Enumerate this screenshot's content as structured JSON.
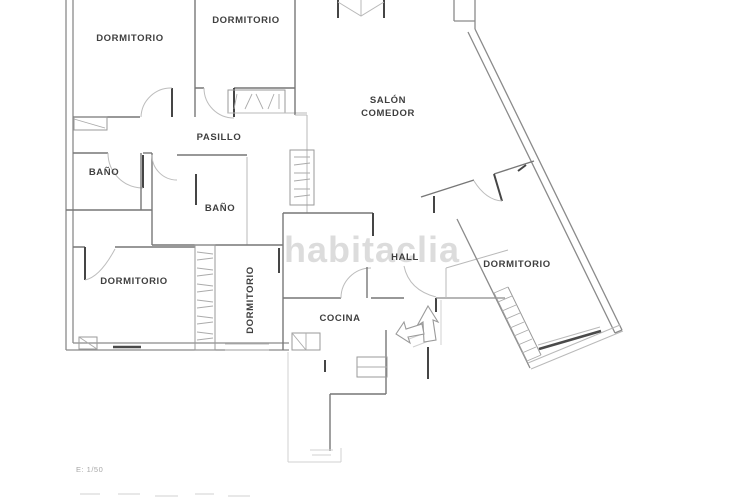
{
  "watermark": {
    "text": "habitaclia",
    "color": "#dcdcdc"
  },
  "scale_note": {
    "text": "E: 1/50"
  },
  "labels": {
    "dormitorio_top_left": "DORMITORIO",
    "dormitorio_top_mid": "DORMITORIO",
    "salon_line1": "SALÓN",
    "salon_line2": "COMEDOR",
    "pasillo": "PASILLO",
    "bano_left": "BAÑO",
    "bano_mid": "BAÑO",
    "dormitorio_bottom_left": "DORMITORIO",
    "dormitorio_bottom_mid": "DORMITORIO",
    "hall": "HALL",
    "cocina": "COCINA",
    "dormitorio_right": "DORMITORIO"
  },
  "colors": {
    "background": "#ffffff",
    "wall": "#8a8a8a",
    "wall_dark": "#454545",
    "wall_light": "#b9b9b9",
    "label_text": "#3f3f3f",
    "watermark": "#dcdcdc",
    "scale_text": "#a8a8a8"
  }
}
